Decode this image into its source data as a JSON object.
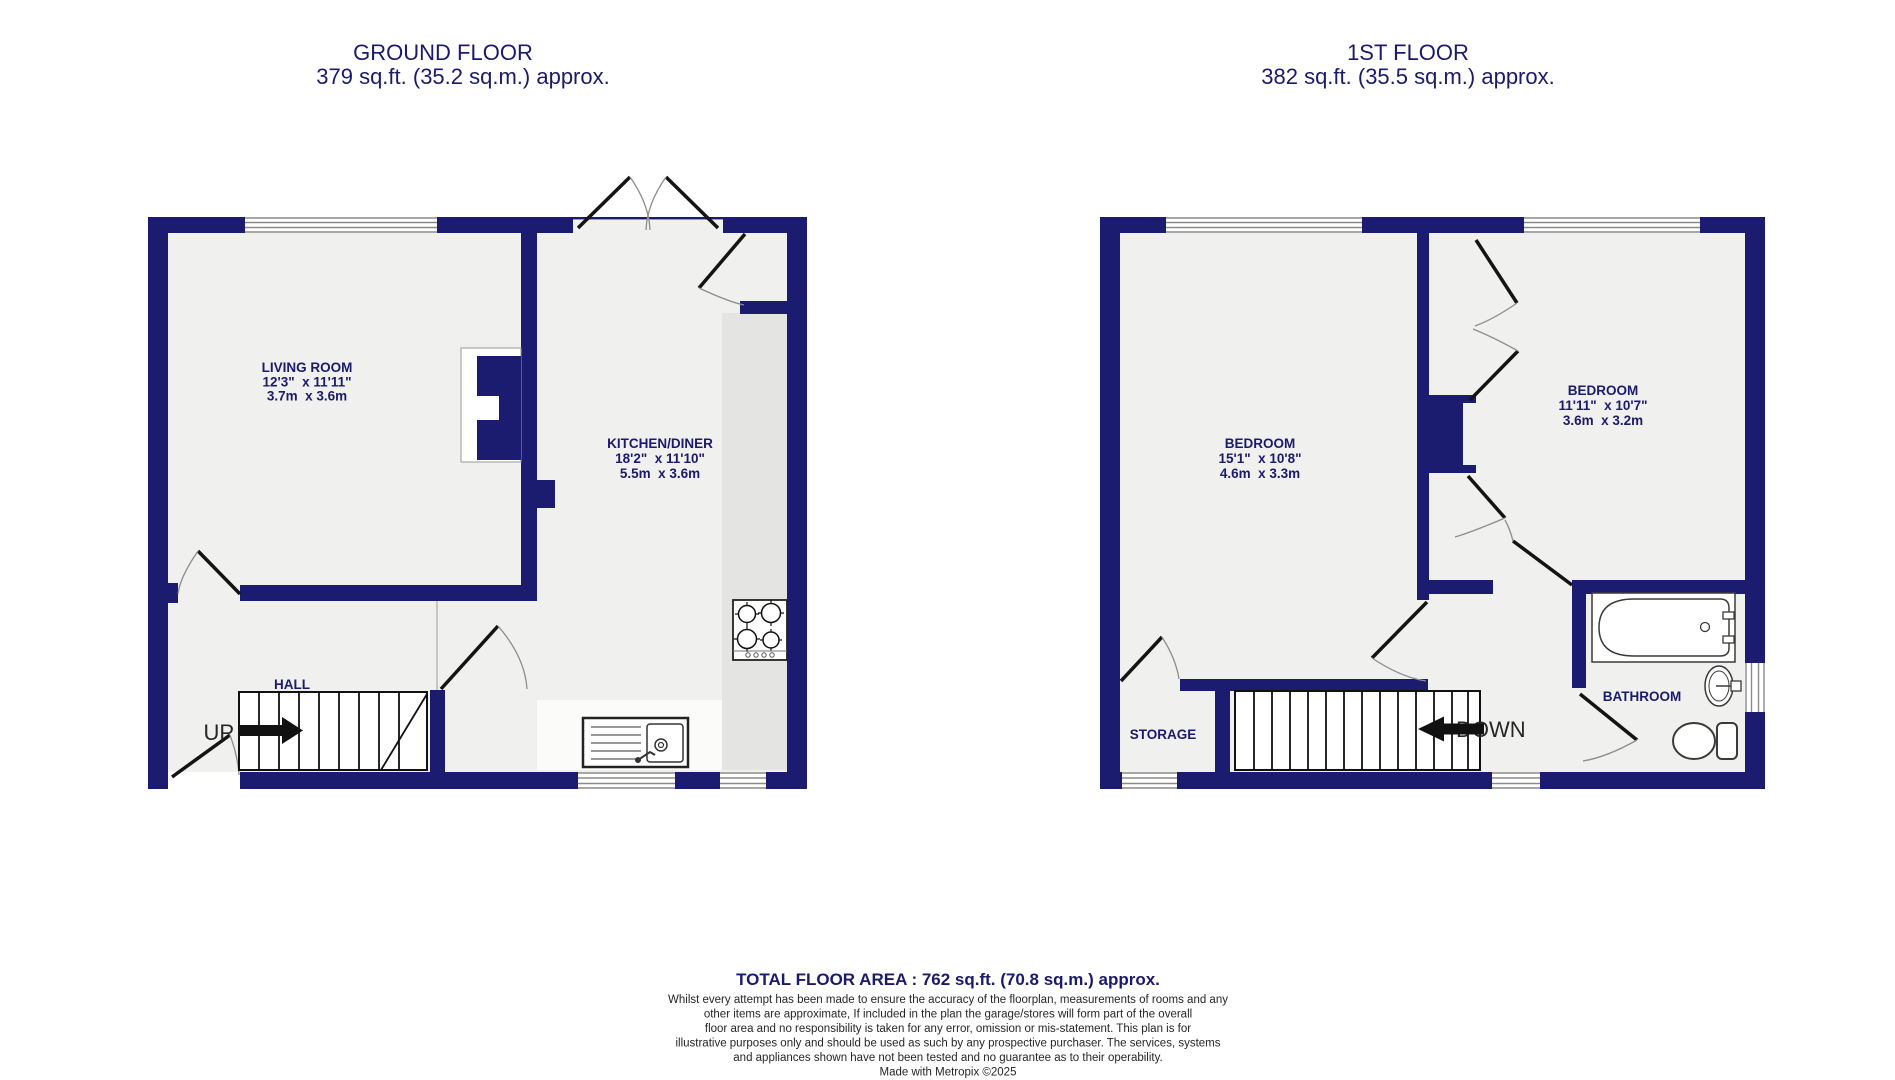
{
  "colors": {
    "wall": "#1b1b70",
    "floor": "#f0f0ee",
    "worktop": "#e4e4e2",
    "counter": "#fbfbf9",
    "label_navy": "#1a1a6e",
    "door_line": "#141414",
    "arc_grey": "#8d8d8d",
    "footnote": "#262626"
  },
  "ground_floor": {
    "title": "GROUND FLOOR",
    "subtitle": "379 sq.ft. (35.2 sq.m.) approx.",
    "hall_label": "HALL",
    "up_label": "UP",
    "living_room": {
      "name": "LIVING ROOM",
      "dims_imperial": "12'3\"  x 11'11\"",
      "dims_metric": "3.7m  x 3.6m"
    },
    "kitchen_diner": {
      "name": "KITCHEN/DINER",
      "dims_imperial": "18'2\"  x 11'10\"",
      "dims_metric": "5.5m  x 3.6m"
    }
  },
  "first_floor": {
    "title": "1ST FLOOR",
    "subtitle": "382 sq.ft. (35.5 sq.m.) approx.",
    "storage_label": "STORAGE",
    "bathroom_label": "BATHROOM",
    "down_label": "DOWN",
    "bedroom_1": {
      "name": "BEDROOM",
      "dims_imperial": "15'1\"  x 10'8\"",
      "dims_metric": "4.6m  x 3.3m"
    },
    "bedroom_2": {
      "name": "BEDROOM",
      "dims_imperial": "11'11\"  x 10'7\"",
      "dims_metric": "3.6m  x 3.2m"
    }
  },
  "footer": {
    "total_area": "TOTAL FLOOR AREA : 762 sq.ft. (70.8 sq.m.) approx.",
    "disclaimer_lines": [
      "Whilst every attempt has been made to ensure the accuracy of the floorplan, measurements of rooms and any",
      "other items are approximate, If included in the plan the garage/stores will form part of the overall",
      "floor area and no responsibility is taken for any error, omission or mis-statement. This plan is for",
      "illustrative purposes only and should be used as such by any prospective purchaser. The services, systems",
      "and appliances shown have not been tested and no guarantee as to their operability.",
      "Made with Metropix ©2025"
    ]
  }
}
